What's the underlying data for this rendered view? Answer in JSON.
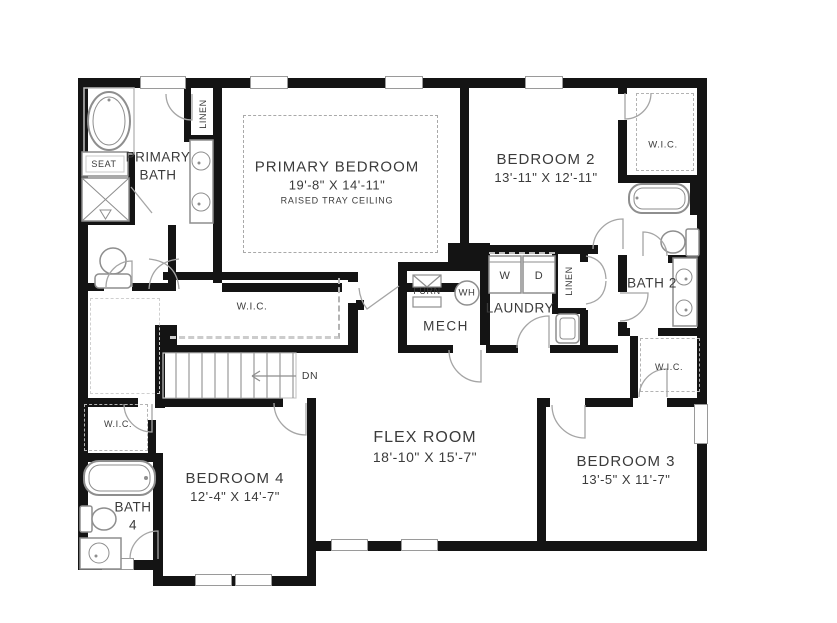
{
  "plan": {
    "rooms": {
      "primary_bedroom": {
        "name": "PRIMARY BEDROOM",
        "dims": "19'-8\" X 14'-11\"",
        "note": "RAISED TRAY CEILING"
      },
      "primary_bath": {
        "name": "PRIMARY BATH"
      },
      "bedroom2": {
        "name": "BEDROOM 2",
        "dims": "13'-11\" X 12'-11\""
      },
      "bedroom3": {
        "name": "BEDROOM 3",
        "dims": "13'-5\" X 11'-7\""
      },
      "bedroom4": {
        "name": "BEDROOM 4",
        "dims": "12'-4\" X 14'-7\""
      },
      "flex_room": {
        "name": "FLEX ROOM",
        "dims": "18'-10\" X 15'-7\""
      },
      "bath2": {
        "name": "BATH 2"
      },
      "bath4": {
        "name": "BATH 4"
      },
      "laundry": {
        "name": "LAUNDRY"
      },
      "mech": {
        "name": "MECH"
      }
    },
    "labels": {
      "wic": "W.I.C.",
      "linen": "LINEN",
      "seat": "SEAT",
      "furnace": "FURN",
      "water_heater": "WH",
      "washer": "W",
      "dryer": "D",
      "stairs_down": "DN"
    },
    "colors": {
      "wall": "#141414",
      "fixture": "#8e8e8e",
      "dashed": "#b3b3b3",
      "text": "#3b3b3b",
      "background": "#ffffff"
    }
  }
}
